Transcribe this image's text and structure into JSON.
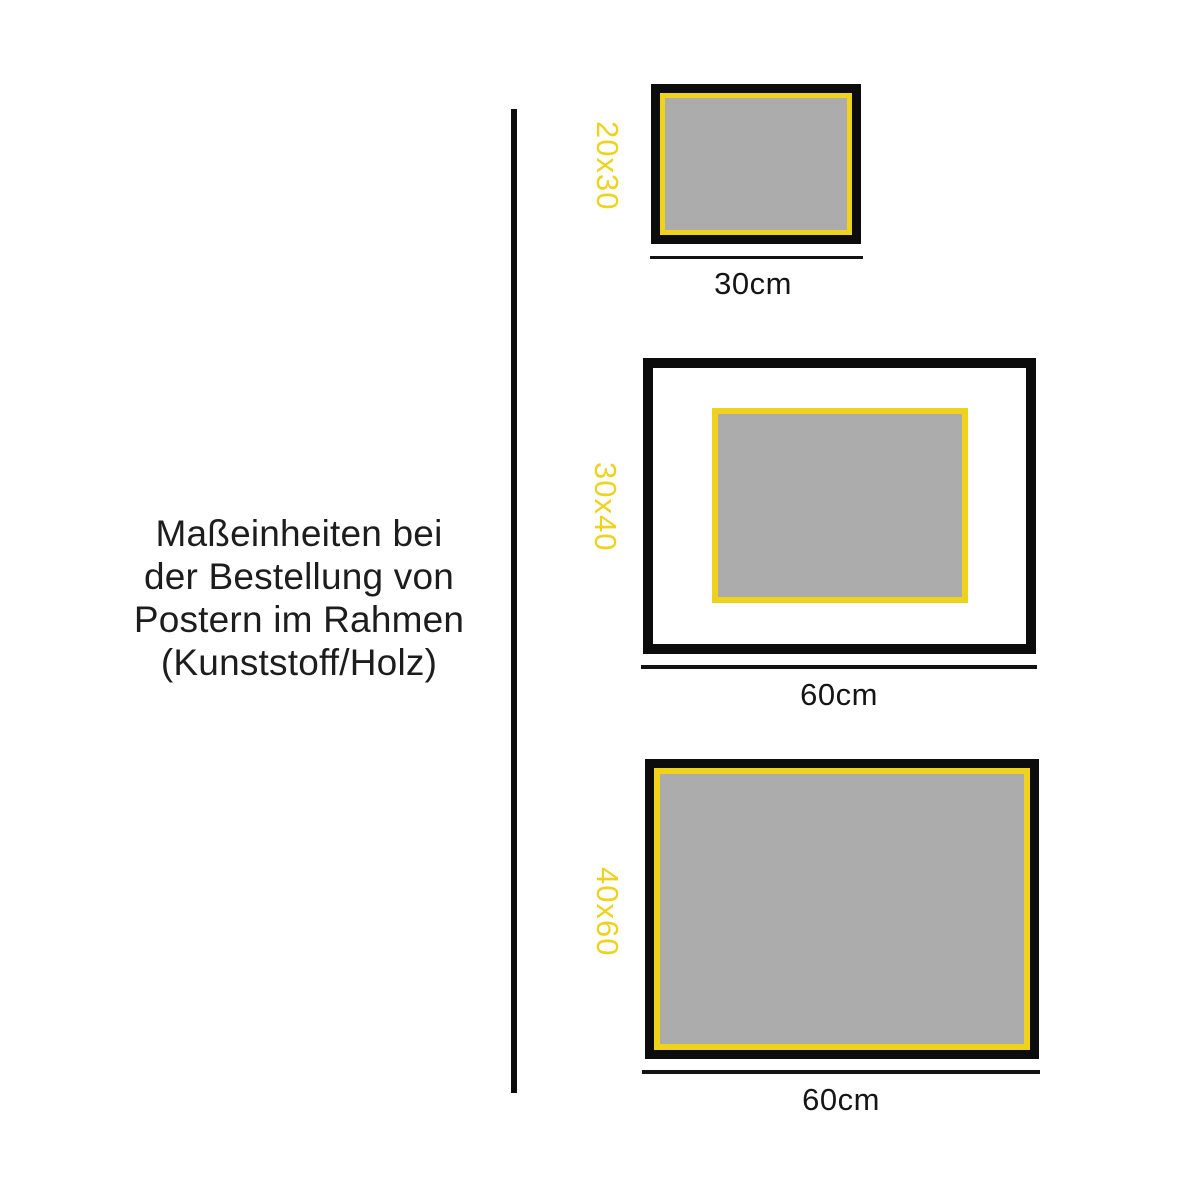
{
  "diagram": {
    "intro": {
      "lines": [
        "Maßeinheiten bei",
        "der Bestellung von",
        "Postern im Rahmen",
        "(Kunststoff/Holz)"
      ]
    },
    "frames": [
      {
        "size_label": "20x30",
        "width_label": "30cm",
        "style": "poster-fills-frame"
      },
      {
        "size_label": "30x40",
        "width_label": "60cm",
        "style": "poster-with-white-mat"
      },
      {
        "size_label": "40x60",
        "width_label": "60cm",
        "style": "poster-fills-frame"
      }
    ],
    "colors": {
      "accent_yellow": "#efd31b",
      "poster_gray": "#acacac",
      "frame_black": "#0c0c0c",
      "text_black": "#1d1d1d",
      "background": "#ffffff"
    }
  }
}
